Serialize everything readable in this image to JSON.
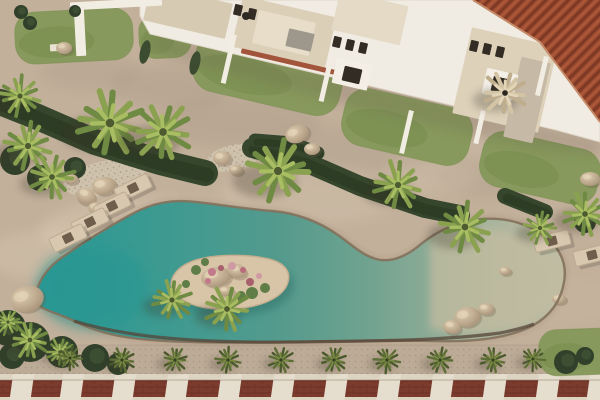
{
  "scene": {
    "palette": {
      "sand": "#c2b09b",
      "stone": "#bcab97",
      "lawn": "#87995c",
      "lawn_dark": "#74894b",
      "building": "#f1ece3",
      "building_edge": "#ded6c7",
      "terrace": "#dccfb8",
      "window": "#332c24",
      "roof": "#9e4c31",
      "roof_rib": "#7a3723",
      "roof_rib_light": "#b25d3c",
      "roof_eave": "#c58a68",
      "road_red": "#7b3b2d",
      "road_dark": "#5f281e",
      "divider": "#e5ddcd",
      "curb": "#ddd3c1",
      "pool_deep": "#2a9894",
      "pool_mid": "#539a8d",
      "pool_shallow": "#c0bda3",
      "pool_rim": "#83715c",
      "pool_rim_dark": "#564437",
      "island_sand": "#d8c5a8",
      "rock_light": "#e0cdb0",
      "rock_dark": "#a08b72",
      "hedge": "#36462c",
      "hedge_dark": "#2c3a24",
      "shadow": "#3a3428",
      "lounger": "#d8c8b0",
      "lounger_edge": "#bcab91",
      "lounger_pillow": "#6f5e4b"
    },
    "mottles": [
      [
        170,
        88,
        60,
        22,
        "#7e6e5e",
        0.12
      ],
      [
        240,
        122,
        80,
        26,
        "#7e6e5e",
        0.12
      ],
      [
        90,
        72,
        50,
        18,
        "#7e6e5e",
        0.1
      ],
      [
        350,
        152,
        90,
        26,
        "#7e6e5e",
        0.1
      ],
      [
        500,
        175,
        65,
        22,
        "#7e6e5e",
        0.1
      ],
      [
        150,
        232,
        110,
        34,
        "#e4d5be",
        0.3
      ],
      [
        310,
        195,
        90,
        30,
        "#e0d1ba",
        0.22
      ],
      [
        520,
        150,
        60,
        20,
        "#ddcfb8",
        0.2
      ],
      [
        60,
        255,
        75,
        26,
        "#e4d5be",
        0.25
      ],
      [
        430,
        175,
        50,
        18,
        "#ddcfb8",
        0.2
      ],
      [
        560,
        300,
        60,
        24,
        "#cbb9a2",
        0.25
      ]
    ],
    "lawns": [
      [
        74,
        36,
        118,
        52,
        -3
      ],
      [
        165,
        36,
        52,
        44,
        -3
      ],
      [
        268,
        74,
        150,
        60,
        13
      ],
      [
        407,
        127,
        130,
        58,
        13
      ],
      [
        540,
        168,
        120,
        56,
        13
      ]
    ],
    "corner_lawn": [
      578,
      352,
      78,
      46,
      -2
    ],
    "gravel": [
      [
        105,
        178,
        42,
        17,
        -12
      ],
      [
        233,
        158,
        27,
        13,
        -12
      ]
    ],
    "buildings": {
      "band_pts": "140,0 600,0 600,142 556,130 150,34 140,16",
      "shadow_pts": "150,34 560,131 600,141 600,154 540,150 420,122 300,92 168,56 150,44",
      "terraces": [
        [
          188,
          12,
          84,
          36,
          13,
          "#d7cab2"
        ],
        [
          284,
          32,
          96,
          52,
          13,
          "#dccfb8"
        ],
        [
          284,
          33,
          58,
          34,
          13,
          "#e7ddc8"
        ],
        [
          300,
          40,
          26,
          18,
          13,
          "#9d978c"
        ],
        [
          370,
          18,
          70,
          40,
          13,
          "#e4dac6"
        ],
        [
          505,
          80,
          88,
          88,
          13,
          "#ddd1ba"
        ],
        [
          527,
          100,
          30,
          82,
          13,
          "#c6b9a5"
        ],
        [
          290,
          62,
          100,
          5,
          13,
          "#a2553a"
        ]
      ],
      "windows": [
        [
          337,
          42
        ],
        [
          350,
          45
        ],
        [
          363,
          48
        ],
        [
          474,
          46
        ],
        [
          487,
          49
        ],
        [
          500,
          52
        ],
        [
          238,
          10
        ],
        [
          252,
          14
        ]
      ],
      "window_size": [
        8,
        11
      ],
      "porches": [
        [
          352,
          74,
          36,
          26
        ],
        [
          500,
          84,
          32,
          26
        ]
      ],
      "doors": [
        [
          352,
          75,
          18,
          15
        ],
        [
          500,
          85,
          16,
          15
        ]
      ],
      "chimney": [
        246,
        16,
        4
      ],
      "roof_pts": "473,0 600,0 600,122 540,42",
      "roof_eave_path": "M 473,0 L 540,42 L 600,122",
      "fences": [
        [
          232,
          34,
          5,
          50
        ],
        [
          329,
          56,
          5,
          46
        ],
        [
          409,
          110,
          5,
          44
        ],
        [
          481,
          110,
          5,
          34
        ],
        [
          544,
          56,
          5,
          40
        ]
      ],
      "pergola": [
        [
          70,
          0,
          92,
          8,
          -3,
          "#f2ede3"
        ],
        [
          75,
          6,
          10,
          50,
          -3,
          "#f2ede3"
        ],
        [
          50,
          44,
          17,
          7,
          -3,
          "#eae3d4"
        ]
      ]
    },
    "promenade": {
      "y": 345,
      "h": 30
    },
    "road": {
      "curb_y": 374,
      "curb_h": 6,
      "red_y": 380,
      "red_h": 17,
      "divider_w": 21,
      "skew": -8,
      "divider_xs": [
        20,
        70,
        122,
        175,
        228,
        281,
        334,
        387,
        440,
        493,
        546,
        597
      ]
    },
    "pool": {
      "outline": "M 36,298 C 36,284 46,268 64,256 C 84,242 106,228 132,214 C 152,203 172,199 196,202 C 222,205 248,209 272,211 C 296,213 318,221 338,235 C 352,245 362,255 376,259 C 390,263 406,257 421,244 C 437,231 458,221 482,219 C 506,217 530,224 547,238 C 561,250 567,265 564,282 C 561,301 550,316 532,326 C 508,338 474,342 438,341 C 398,340 340,341 290,342 C 240,343 190,343 152,340 C 120,338 94,331 74,321 C 54,311 36,310 36,298 Z",
      "gradient": [
        [
          0,
          "#2a9894"
        ],
        [
          0.22,
          "#3b9a91"
        ],
        [
          0.45,
          "#539a8d"
        ],
        [
          0.62,
          "#6ea28f"
        ],
        [
          0.78,
          "#95ad97"
        ],
        [
          0.9,
          "#b2b79f"
        ],
        [
          1,
          "#c0bda3"
        ]
      ],
      "deep_overlay": [
        92,
        288,
        56,
        42,
        "#259692",
        0.55
      ],
      "shallow_path": "M 430,232 C 470,224 510,228 534,244 C 554,258 560,276 554,294 C 546,314 524,327 496,331 C 468,335 444,333 430,328 Z",
      "south_rim": "M 74,321 C 130,338 200,343 290,342 C 370,341 440,341 500,333 C 515,330 526,327 534,324",
      "island": {
        "path": "M 173,291 C 167,279 177,266 196,260 C 216,254 248,254 269,259 C 285,263 291,272 288,282 C 285,294 270,303 249,307 C 228,311 204,310 189,303 C 179,299 176,296 173,291 Z",
        "rocks": [
          [
            216,
            277,
            15,
            10,
            -8
          ],
          [
            237,
            271,
            10,
            7,
            12
          ],
          [
            226,
            291,
            8,
            5,
            0
          ]
        ],
        "flowers": [
          [
            212,
            272,
            4,
            "#c2798a"
          ],
          [
            221,
            268,
            3,
            "#a85f6e"
          ],
          [
            232,
            266,
            4,
            "#d09aa5"
          ],
          [
            243,
            270,
            3,
            "#b96b7b"
          ],
          [
            208,
            281,
            3,
            "#c2798a"
          ],
          [
            250,
            282,
            4,
            "#a85f6e"
          ],
          [
            259,
            276,
            3,
            "#d09aa5"
          ]
        ],
        "tufts": [
          [
            196,
            270,
            5
          ],
          [
            252,
            293,
            6
          ],
          [
            265,
            288,
            5
          ],
          [
            186,
            284,
            4
          ],
          [
            241,
            296,
            5
          ],
          [
            205,
            262,
            4
          ]
        ]
      },
      "rocks": [
        [
          467,
          317,
          13,
          10,
          -10
        ],
        [
          452,
          327,
          9,
          7,
          8
        ],
        [
          486,
          309,
          8,
          6,
          0
        ],
        [
          505,
          271,
          6,
          4,
          0
        ],
        [
          559,
          299,
          7,
          5,
          0
        ]
      ]
    },
    "hedges": [
      {
        "pts": [
          [
            0,
            102
          ],
          [
            40,
            118
          ],
          [
            95,
            142
          ],
          [
            160,
            162
          ],
          [
            205,
            173
          ]
        ],
        "w": 26
      },
      {
        "pts": [
          [
            252,
            148
          ],
          [
            305,
            162
          ],
          [
            360,
            186
          ],
          [
            425,
            208
          ],
          [
            460,
            215
          ]
        ],
        "w": 20
      },
      {
        "pts": [
          [
            255,
            140
          ],
          [
            292,
            143
          ],
          [
            318,
            153
          ]
        ],
        "w": 13
      },
      {
        "pts": [
          [
            505,
            196
          ],
          [
            545,
            212
          ]
        ],
        "w": 16
      }
    ],
    "shrubs": [
      [
        15,
        160,
        15
      ],
      [
        40,
        178,
        13
      ],
      [
        75,
        168,
        11
      ],
      [
        8,
        328,
        18
      ],
      [
        30,
        342,
        20
      ],
      [
        62,
        352,
        16
      ],
      [
        95,
        358,
        14
      ],
      [
        118,
        364,
        11
      ],
      [
        12,
        356,
        13
      ],
      [
        566,
        362,
        12
      ],
      [
        585,
        356,
        9
      ],
      [
        21,
        12,
        7
      ],
      [
        30,
        23,
        7
      ],
      [
        75,
        11,
        6
      ],
      [
        585,
        222,
        11
      ]
    ],
    "cypresses": [
      [
        145,
        52
      ],
      [
        195,
        63
      ]
    ],
    "rocks": [
      [
        27,
        299,
        17,
        13,
        -15
      ],
      [
        64,
        48,
        8,
        6,
        0
      ],
      [
        86,
        196,
        10,
        8,
        20
      ],
      [
        104,
        186,
        12,
        9,
        -10
      ],
      [
        96,
        208,
        8,
        6,
        0
      ],
      [
        71,
        179,
        7,
        5,
        0
      ],
      [
        297,
        134,
        12,
        9,
        -20
      ],
      [
        312,
        149,
        8,
        6,
        0
      ],
      [
        590,
        179,
        10,
        7,
        0
      ],
      [
        222,
        158,
        9,
        7,
        0
      ],
      [
        236,
        170,
        7,
        5,
        0
      ]
    ],
    "loungers": {
      "size": [
        36,
        15
      ],
      "items": [
        [
          133,
          188,
          -26
        ],
        [
          112,
          206,
          -26
        ],
        [
          90,
          222,
          -26
        ],
        [
          68,
          238,
          -26
        ],
        [
          552,
          241,
          -14
        ],
        [
          592,
          255,
          -14
        ]
      ]
    },
    "palms": {
      "light": [
        [
          20,
          96,
          22
        ],
        [
          28,
          146,
          26
        ],
        [
          52,
          177,
          24
        ],
        [
          110,
          123,
          36
        ],
        [
          163,
          132,
          32
        ],
        [
          278,
          171,
          34
        ],
        [
          398,
          185,
          26
        ],
        [
          465,
          227,
          28
        ],
        [
          540,
          228,
          18
        ],
        [
          585,
          214,
          24
        ],
        [
          30,
          340,
          20
        ],
        [
          60,
          352,
          15
        ],
        [
          8,
          322,
          14
        ]
      ],
      "island": [
        [
          172,
          300,
          22
        ],
        [
          227,
          309,
          24
        ]
      ],
      "olive": [
        [
          70,
          358,
          13
        ],
        [
          122,
          360,
          14
        ],
        [
          175,
          360,
          14
        ],
        [
          228,
          360,
          14
        ],
        [
          281,
          360,
          14
        ],
        [
          334,
          360,
          14
        ],
        [
          387,
          360,
          14
        ],
        [
          440,
          360,
          14
        ],
        [
          493,
          360,
          14
        ],
        [
          533,
          359,
          13
        ]
      ],
      "dead": [
        505,
        93,
        24
      ]
    },
    "palm_colors": {
      "light": [
        "#8aa14f",
        "#6f8a42",
        "#a9bd62",
        "#4c5c30"
      ],
      "olive": [
        "#5d6d36",
        "#4a592c",
        "#7b8b44",
        "#334022"
      ],
      "dead": [
        "#d3c4a6",
        "#bfae8e",
        "#e2d5b8",
        "#2e271f"
      ]
    }
  }
}
